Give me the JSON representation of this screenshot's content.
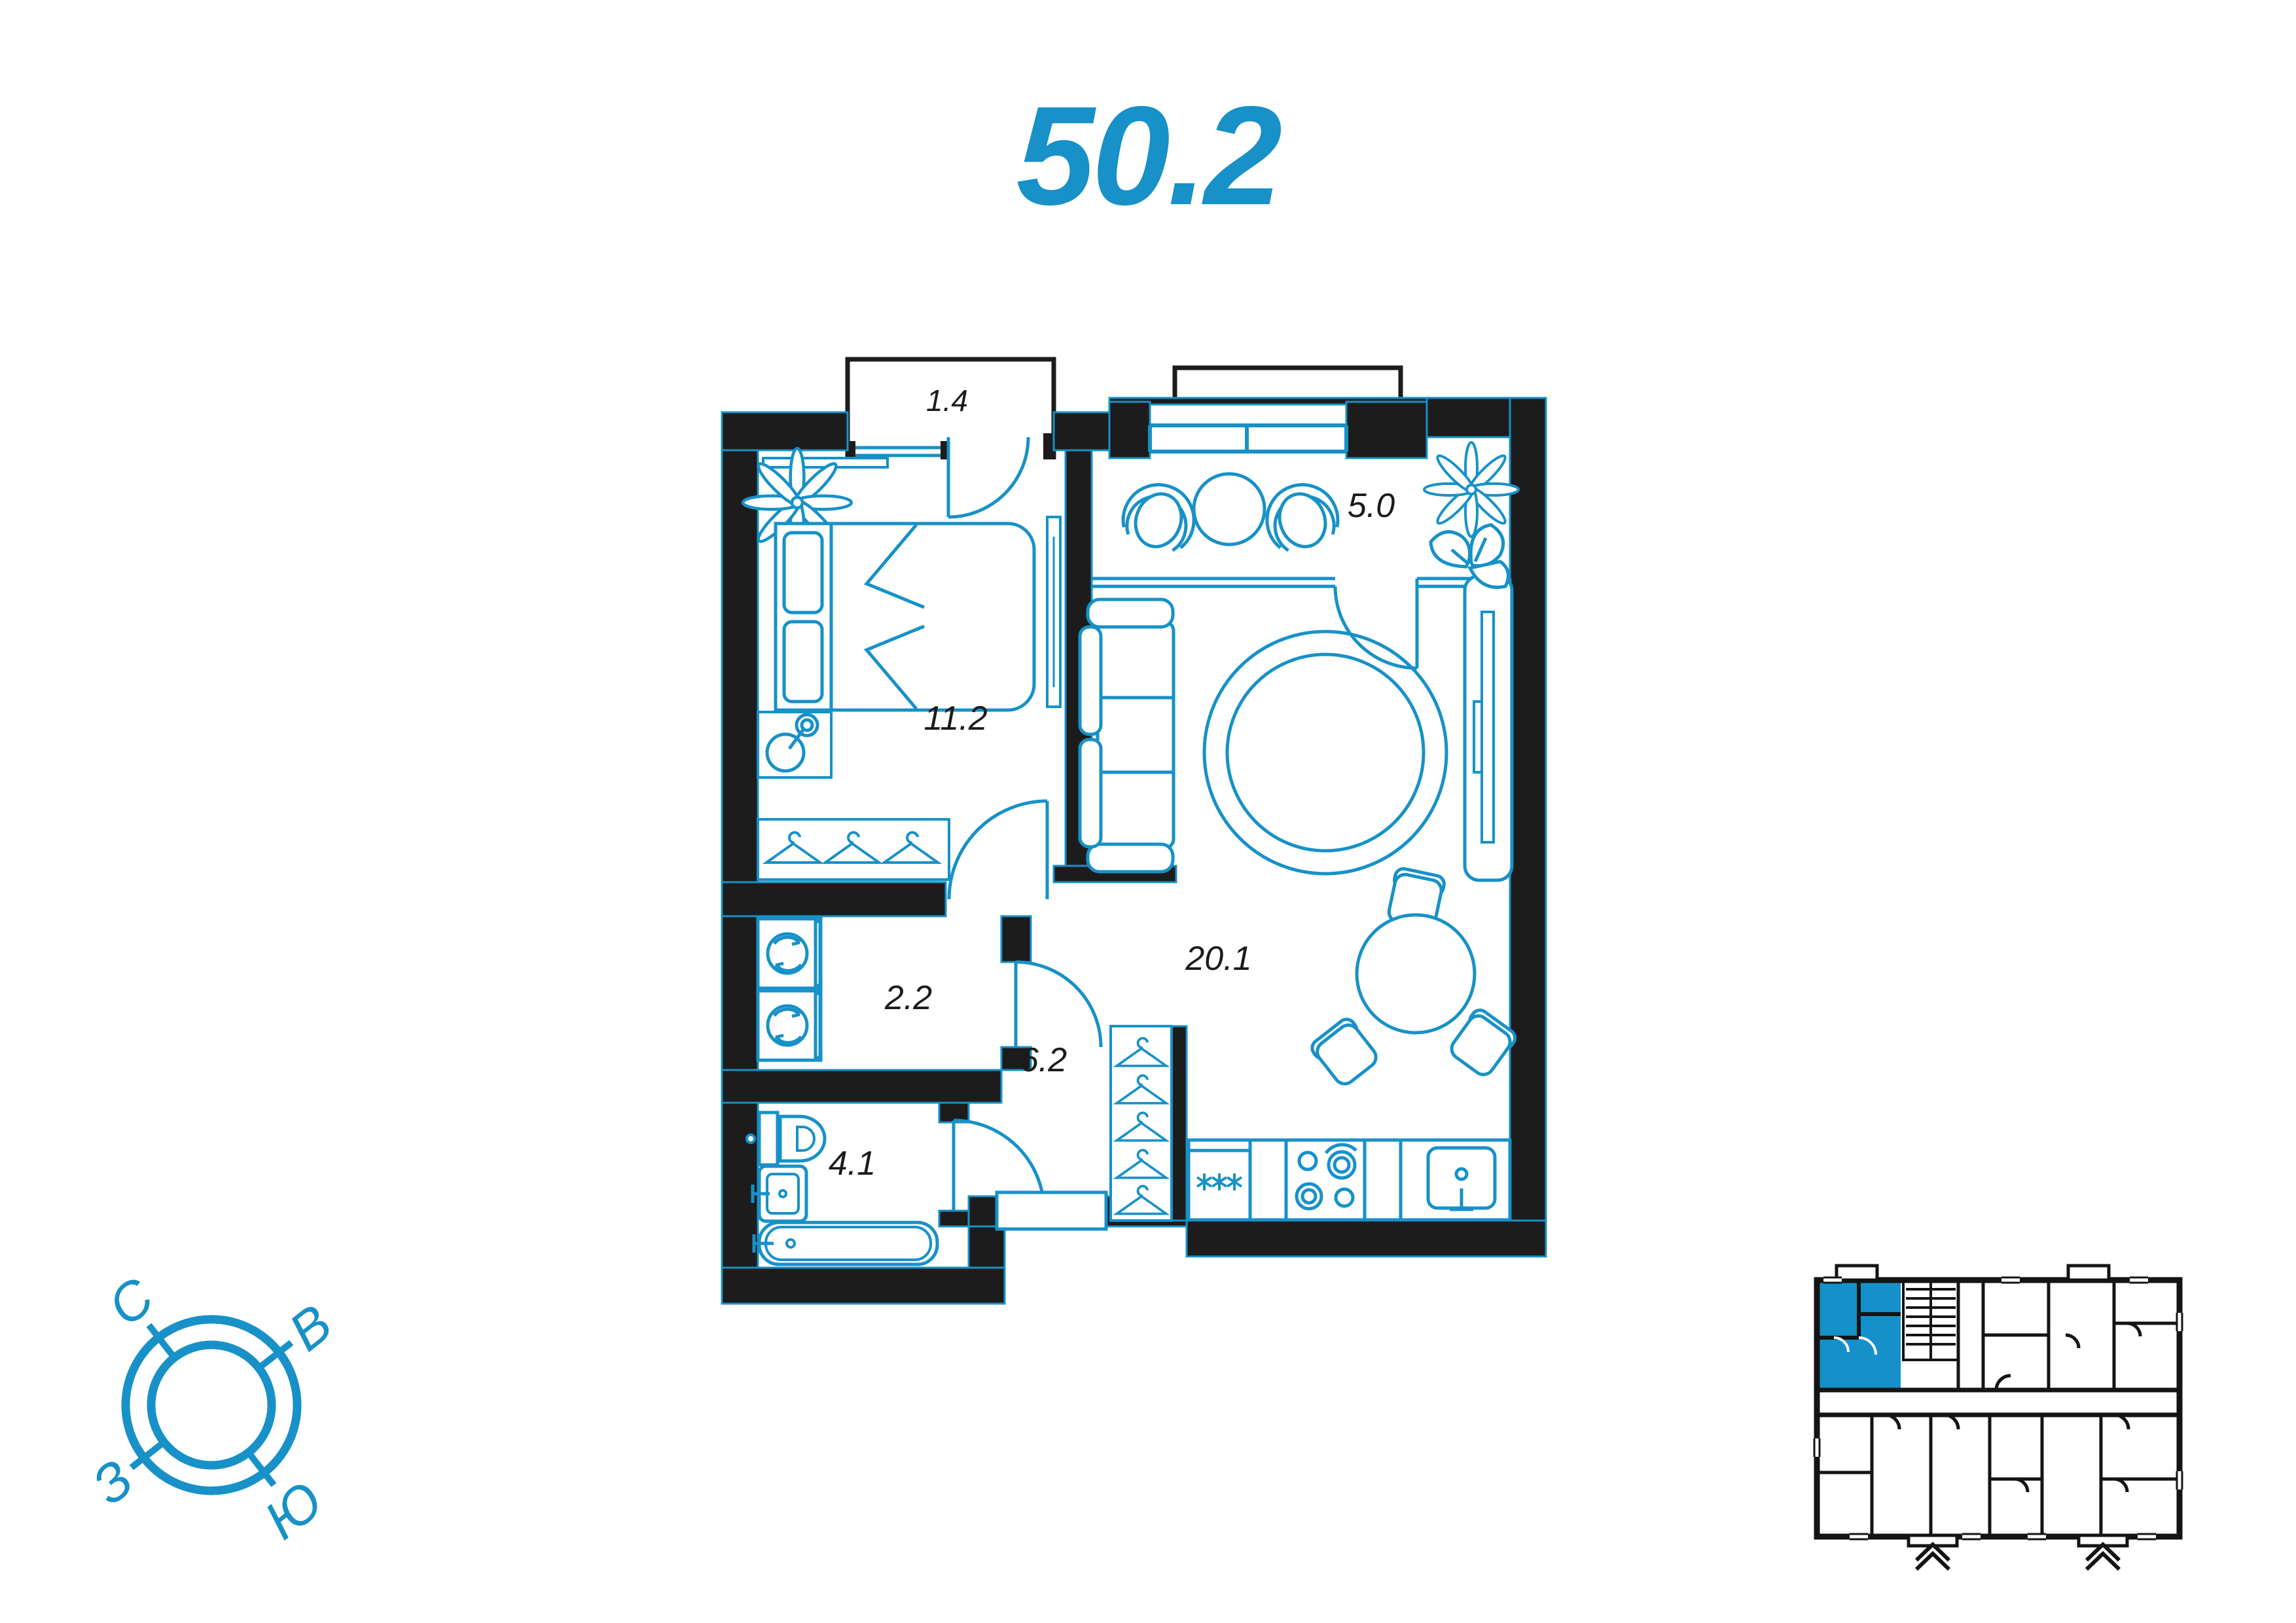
{
  "title": "50.2",
  "rooms": [
    {
      "name": "balcony",
      "area": "1.4"
    },
    {
      "name": "loggia",
      "area": "5.0"
    },
    {
      "name": "bedroom",
      "area": "11.2"
    },
    {
      "name": "storage",
      "area": "2.2"
    },
    {
      "name": "living-kitchen",
      "area": "20.1"
    },
    {
      "name": "hallway",
      "area": "6.2"
    },
    {
      "name": "bathroom",
      "area": "4.1"
    }
  ],
  "compass": {
    "north": "С",
    "east": "В",
    "west": "З",
    "south": "Ю"
  },
  "colors": {
    "accent": "#1791c8",
    "wall": "#1c1c1c",
    "keyplan_highlight": "#1590c8",
    "label": "#1b1b1b"
  }
}
